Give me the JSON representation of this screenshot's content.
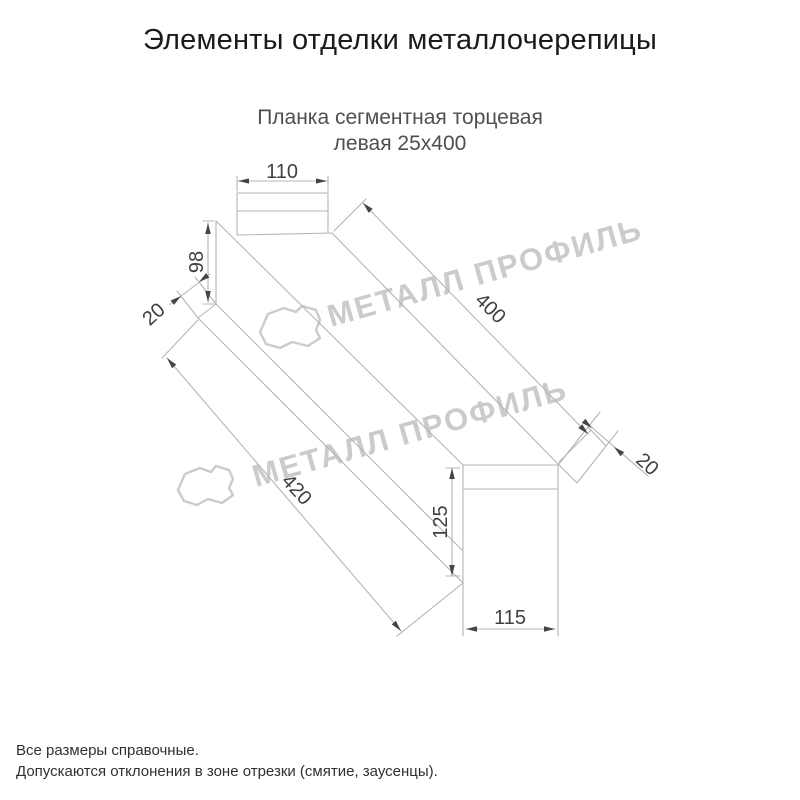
{
  "page": {
    "title": "Элементы отделки металлочерепицы"
  },
  "drawing": {
    "subtitle_line1": "Планка сегментная торцевая",
    "subtitle_line2": "левая 25х400",
    "dimensions": {
      "top_width": "110",
      "left_height": "98",
      "left_fold": "20",
      "top_length": "400",
      "bottom_length": "420",
      "end_height": "125",
      "end_width": "115",
      "end_fold": "20"
    },
    "watermark": {
      "text": "МЕТАЛЛ ПРОФИЛЬ"
    },
    "colors": {
      "line": "#b5b5b5",
      "arrow": "#454545",
      "dim_text": "#3f3f3f",
      "watermark": "#cbcbcb"
    }
  },
  "footer": {
    "line1": "Все размеры справочные.",
    "line2": "Допускаются отклонения в зоне отрезки (смятие, заусенцы)."
  }
}
